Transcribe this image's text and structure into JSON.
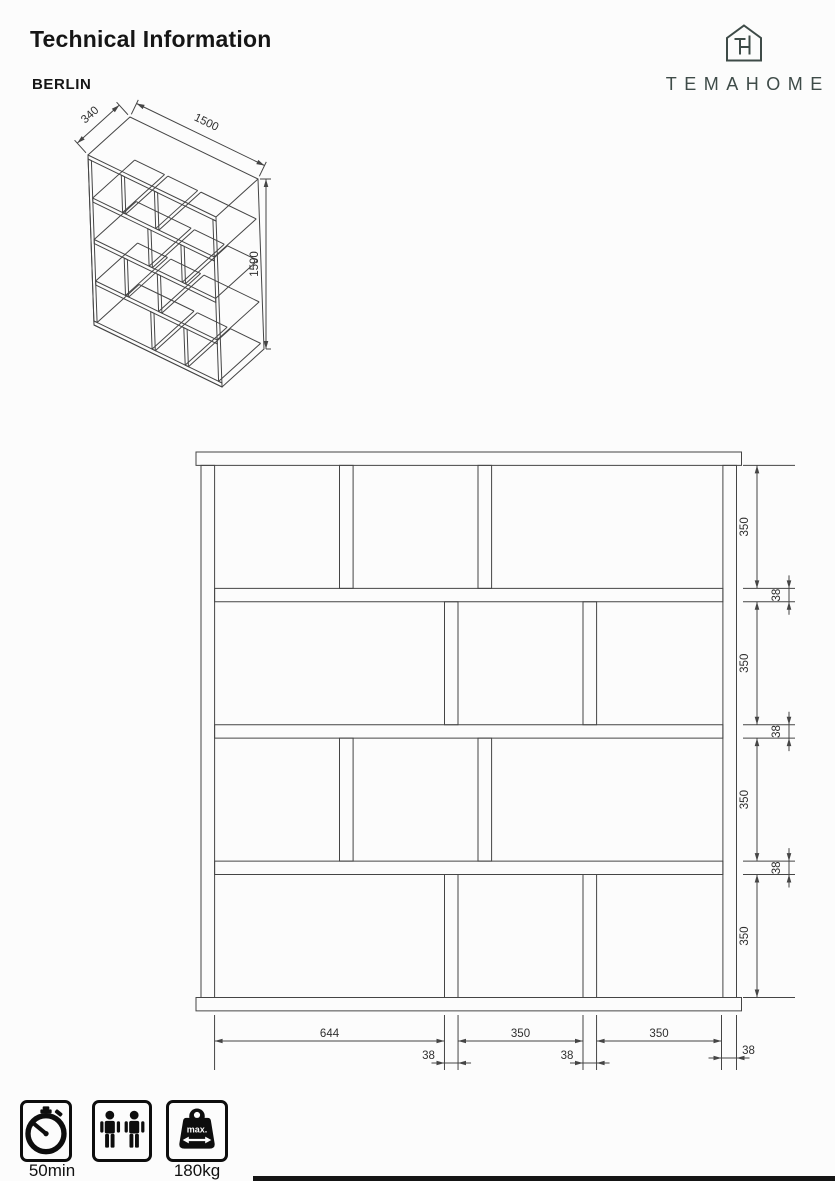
{
  "header": {
    "title": "Technical Information",
    "product_name": "BERLIN",
    "brand": "TEMAHOME"
  },
  "iso_view": {
    "depth_label": "340",
    "width_label": "1500",
    "height_label": "1590"
  },
  "front_view": {
    "vertical_opening_labels": [
      "350",
      "350",
      "350",
      "350"
    ],
    "vertical_gap_labels": [
      "38",
      "38",
      "38"
    ],
    "bottom_segment_labels": [
      "644",
      "350",
      "350"
    ],
    "bottom_gap_labels": [
      "38",
      "38"
    ],
    "side_panel_label": "38"
  },
  "footer": {
    "assembly_time": "50min",
    "max_load": "180kg",
    "max_text": "max.",
    "person_icons": 2
  },
  "colors": {
    "line": "#454545",
    "brand": "#3e4b48",
    "ink": "#161616"
  }
}
